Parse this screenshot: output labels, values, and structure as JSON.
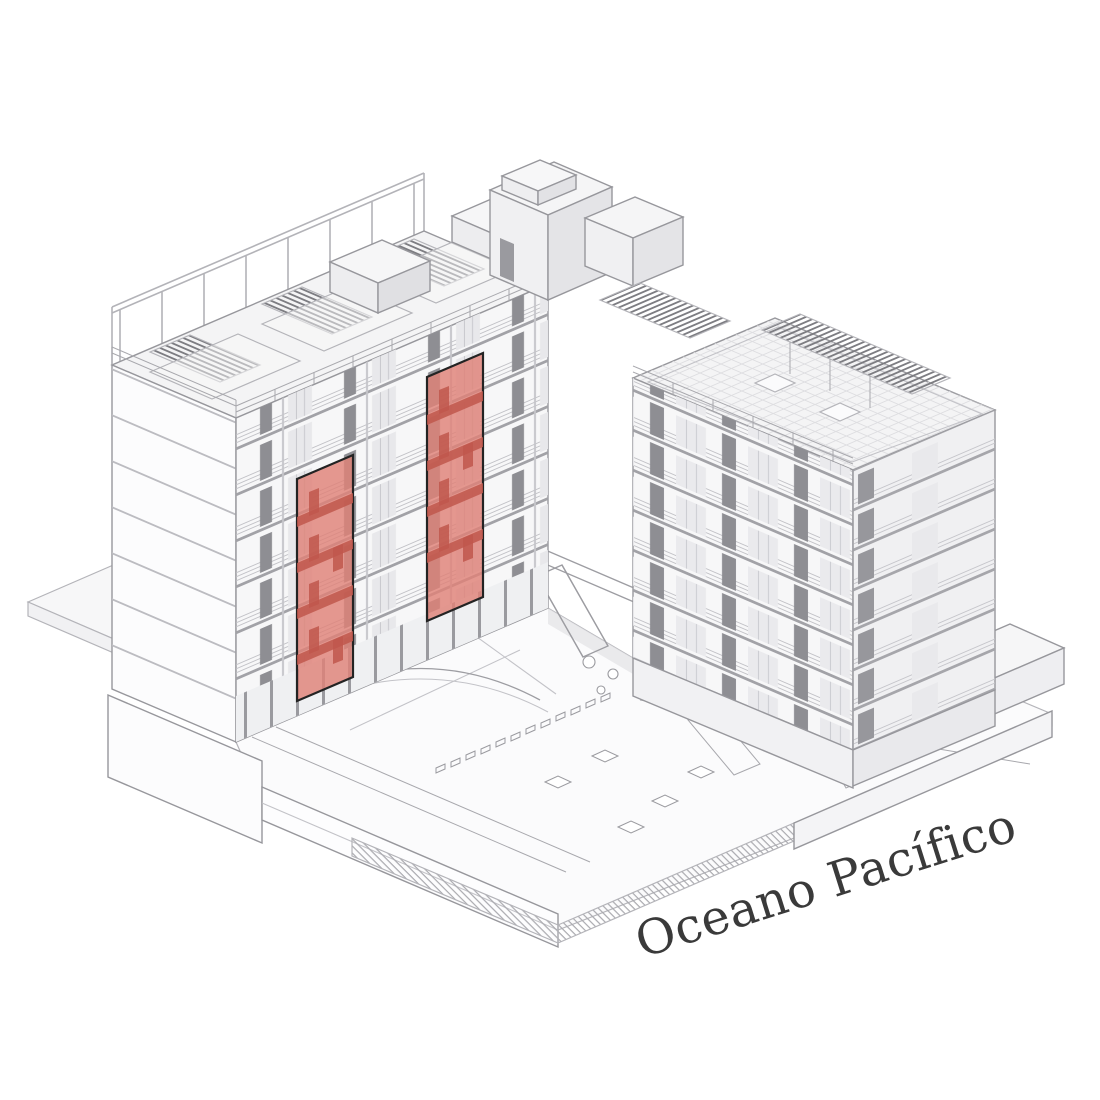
{
  "figure": {
    "type": "axonometric-architecture-diagram",
    "background_color": "#ffffff",
    "label": {
      "text": "Oceano Pacífico",
      "color": "#3a3a3a",
      "rotation_deg": -17.5,
      "font_size_px": 48
    },
    "highlight": {
      "name": "highlighted-apartment-units",
      "count": 2,
      "fill": "#df8177",
      "fill_opacity": "0.82",
      "detail_fill": "#bf574c",
      "outline": "#232323"
    },
    "palette": {
      "line_light": "#c3c3c8",
      "line_mid": "#9d9da2",
      "line_dark": "#7d7d82",
      "panel_dark": "#8e8e93",
      "face_white": "#fbfbfc",
      "face_light": "#f4f4f5",
      "face_mid": "#e9e9ec"
    },
    "scene": {
      "left_wing_floors_visible": 7,
      "right_wing_floors_visible": 7,
      "highlighted_unit_stacks": 2
    }
  }
}
